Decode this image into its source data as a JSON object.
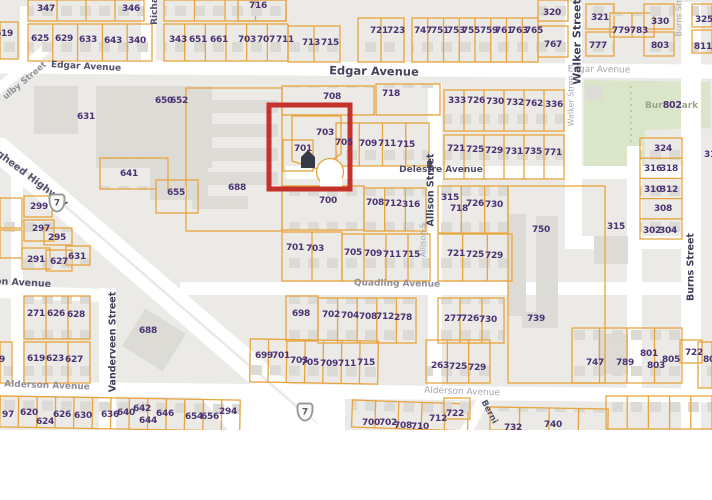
{
  "map": {
    "colors": {
      "block": "#ebeae6",
      "road": "#ffffff",
      "parcel_line": "#e8a43e",
      "building": "#dcdbd6",
      "park": "#dbe5c9",
      "number_text": "#4a3273",
      "highlight": "#c5312b"
    },
    "highlight": {
      "x": 269,
      "y": 105,
      "w": 81,
      "h": 84,
      "stroke": 5
    },
    "highway_shields": [
      {
        "label": "7",
        "x": 57,
        "y": 203
      },
      {
        "label": "7",
        "x": 305,
        "y": 412
      }
    ],
    "park_label": {
      "pre": "Bur",
      "number": "802",
      "post": "ark"
    },
    "street_labels": [
      {
        "t": "Edgar Avenue",
        "x": 86,
        "y": 67,
        "rot": 3,
        "cls": "s-dark",
        "size": 9
      },
      {
        "t": "Edgar Avenue",
        "x": 374,
        "y": 71,
        "rot": 1,
        "cls": "s-bold",
        "size": 11.5
      },
      {
        "t": "Edgar Avenue",
        "x": 599,
        "y": 70,
        "rot": 1,
        "cls": "s-light",
        "size": 9
      },
      {
        "t": "Delestre Avenue",
        "x": 441,
        "y": 170,
        "rot": 0,
        "cls": "s-dark",
        "size": 9
      },
      {
        "t": "Quadling Avenue",
        "x": 397,
        "y": 284,
        "rot": 1,
        "cls": "s-mid",
        "size": 9
      },
      {
        "t": "Alderson Avenue",
        "x": 47,
        "y": 386,
        "rot": 2,
        "cls": "s-mid",
        "size": 9
      },
      {
        "t": "Alderson Avenue",
        "x": 462,
        "y": 392,
        "rot": 2,
        "cls": "s-light",
        "size": 9
      },
      {
        "t": "Walker Street",
        "x": 577,
        "y": 42,
        "rot": -90,
        "cls": "s-bold2",
        "size": 11
      },
      {
        "t": "Walker Stree",
        "x": 571,
        "y": 101,
        "rot": -90,
        "cls": "s-light",
        "size": 8
      },
      {
        "t": "Burns Str",
        "x": 679,
        "y": 18,
        "rot": -90,
        "cls": "s-light",
        "size": 8
      },
      {
        "t": "Burns Street",
        "x": 691,
        "y": 267,
        "rot": -90,
        "cls": "s-bold2",
        "size": 9.5
      },
      {
        "t": "Allison Street",
        "x": 431,
        "y": 190,
        "rot": -90,
        "cls": "s-bold2",
        "size": 9.5
      },
      {
        "t": "Allison S",
        "x": 423,
        "y": 240,
        "rot": -90,
        "cls": "s-light",
        "size": 8
      },
      {
        "t": "Vanderveen Street",
        "x": 113,
        "y": 342,
        "rot": -90,
        "cls": "s-bold2",
        "size": 9.5
      },
      {
        "t": "Richa",
        "x": 155,
        "y": 11,
        "rot": -90,
        "cls": "s-dark",
        "size": 9
      },
      {
        "t": "gheed Highway",
        "x": 32,
        "y": 179,
        "rot": 37,
        "cls": "s-hwy",
        "size": 10
      },
      {
        "t": "ulby Street",
        "x": 25,
        "y": 81,
        "rot": -40,
        "cls": "s-mid",
        "size": 8.5
      },
      {
        "t": "on Avenue",
        "x": 23,
        "y": 283,
        "rot": 3,
        "cls": "s-dark",
        "size": 9.5
      },
      {
        "t": "Berni",
        "x": 489,
        "y": 412,
        "rot": 62,
        "cls": "s-dark",
        "size": 8.5
      }
    ],
    "parcel_numbers": [
      [
        "347",
        46,
        9
      ],
      [
        "346",
        131,
        9
      ],
      [
        "619",
        4,
        34
      ],
      [
        "625",
        40,
        39
      ],
      [
        "629",
        64,
        39
      ],
      [
        "633",
        88,
        40
      ],
      [
        "643",
        113,
        41
      ],
      [
        "340",
        137,
        41
      ],
      [
        "343",
        178,
        40
      ],
      [
        "651",
        198,
        40
      ],
      [
        "661",
        219,
        40
      ],
      [
        "703",
        247,
        40
      ],
      [
        "707",
        266,
        40
      ],
      [
        "711",
        285,
        40
      ],
      [
        "713",
        311,
        43
      ],
      [
        "715",
        330,
        43
      ],
      [
        "716",
        258,
        6
      ],
      [
        "721",
        379,
        31
      ],
      [
        "723",
        396,
        31
      ],
      [
        "747",
        423,
        31
      ],
      [
        "751",
        440,
        31
      ],
      [
        "753",
        456,
        31
      ],
      [
        "755",
        471,
        31
      ],
      [
        "759",
        489,
        31
      ],
      [
        "761",
        504,
        31
      ],
      [
        "763",
        519,
        31
      ],
      [
        "765",
        534,
        31
      ],
      [
        "320",
        552,
        13
      ],
      [
        "767",
        553,
        45
      ],
      [
        "321",
        600,
        18
      ],
      [
        "777",
        598,
        46
      ],
      [
        "779",
        621,
        31
      ],
      [
        "783",
        639,
        31
      ],
      [
        "330",
        660,
        22
      ],
      [
        "803",
        660,
        46
      ],
      [
        "325",
        704,
        20
      ],
      [
        "811",
        703,
        47
      ],
      [
        "650",
        164,
        101
      ],
      [
        "652",
        179,
        101
      ],
      [
        "631",
        86,
        117
      ],
      [
        "708",
        332,
        97
      ],
      [
        "718",
        391,
        94
      ],
      [
        "333",
        457,
        101
      ],
      [
        "726",
        476,
        101
      ],
      [
        "730",
        495,
        102
      ],
      [
        "732",
        515,
        103
      ],
      [
        "762",
        534,
        104
      ],
      [
        "336",
        554,
        105
      ],
      [
        "703",
        325,
        133
      ],
      [
        "701",
        303,
        149
      ],
      [
        "705",
        344,
        143
      ],
      [
        "709",
        368,
        144
      ],
      [
        "711",
        387,
        144
      ],
      [
        "715",
        406,
        145
      ],
      [
        "721",
        456,
        149
      ],
      [
        "725",
        475,
        150
      ],
      [
        "729",
        494,
        151
      ],
      [
        "731",
        514,
        152
      ],
      [
        "735",
        533,
        152
      ],
      [
        "771",
        553,
        153
      ],
      [
        "641",
        129,
        174
      ],
      [
        "655",
        176,
        193
      ],
      [
        "688",
        237,
        188
      ],
      [
        "299",
        39,
        207
      ],
      [
        "297",
        41,
        229
      ],
      [
        "295",
        57,
        238
      ],
      [
        "291",
        36,
        260
      ],
      [
        "627",
        59,
        262
      ],
      [
        "631",
        77,
        257
      ],
      [
        "700",
        328,
        201
      ],
      [
        "708",
        375,
        203
      ],
      [
        "712",
        393,
        204
      ],
      [
        "316",
        411,
        205
      ],
      [
        "315",
        450,
        198
      ],
      [
        "718",
        459,
        209
      ],
      [
        "726",
        475,
        204
      ],
      [
        "730",
        494,
        205
      ],
      [
        "701",
        295,
        248
      ],
      [
        "703",
        315,
        249
      ],
      [
        "705",
        353,
        253
      ],
      [
        "709",
        373,
        254
      ],
      [
        "711",
        392,
        255
      ],
      [
        "715",
        411,
        255
      ],
      [
        "721",
        456,
        254
      ],
      [
        "725",
        475,
        255
      ],
      [
        "729",
        494,
        256
      ],
      [
        "750",
        541,
        230
      ],
      [
        "739",
        536,
        319
      ],
      [
        "324",
        663,
        149
      ],
      [
        "316",
        653,
        169
      ],
      [
        "318",
        669,
        169
      ],
      [
        "310",
        653,
        190
      ],
      [
        "312",
        669,
        190
      ],
      [
        "308",
        663,
        209
      ],
      [
        "302",
        652,
        231
      ],
      [
        "304",
        668,
        231
      ],
      [
        "315",
        616,
        227
      ],
      [
        "31",
        710,
        155
      ],
      [
        "698",
        301,
        314
      ],
      [
        "702",
        331,
        315
      ],
      [
        "704",
        350,
        316
      ],
      [
        "708",
        368,
        317
      ],
      [
        "712",
        385,
        317
      ],
      [
        "278",
        403,
        318
      ],
      [
        "277",
        453,
        319
      ],
      [
        "726",
        470,
        319
      ],
      [
        "730",
        488,
        320
      ],
      [
        "271",
        36,
        314
      ],
      [
        "626",
        56,
        314
      ],
      [
        "628",
        76,
        315
      ],
      [
        "619",
        36,
        359
      ],
      [
        "623",
        55,
        359
      ],
      [
        "627",
        74,
        360
      ],
      [
        "9",
        2,
        360
      ],
      [
        "688",
        148,
        331
      ],
      [
        "699",
        264,
        356
      ],
      [
        "701",
        281,
        356
      ],
      [
        "703",
        299,
        361
      ],
      [
        "705",
        310,
        363
      ],
      [
        "709",
        329,
        364
      ],
      [
        "711",
        347,
        364
      ],
      [
        "715",
        366,
        363
      ],
      [
        "263",
        440,
        366
      ],
      [
        "725",
        458,
        367
      ],
      [
        "729",
        477,
        368
      ],
      [
        "747",
        595,
        363
      ],
      [
        "789",
        625,
        363
      ],
      [
        "801",
        649,
        354
      ],
      [
        "803",
        656,
        366
      ],
      [
        "805",
        671,
        360
      ],
      [
        "80",
        709,
        360
      ],
      [
        "722",
        694,
        353
      ],
      [
        "97",
        8,
        415
      ],
      [
        "620",
        29,
        413
      ],
      [
        "624",
        45,
        422
      ],
      [
        "626",
        62,
        415
      ],
      [
        "630",
        83,
        416
      ],
      [
        "636",
        110,
        415
      ],
      [
        "640",
        126,
        413
      ],
      [
        "642",
        142,
        409
      ],
      [
        "644",
        148,
        421
      ],
      [
        "646",
        165,
        414
      ],
      [
        "654",
        194,
        417
      ],
      [
        "656",
        210,
        417
      ],
      [
        "294",
        228,
        412
      ],
      [
        "700",
        371,
        423
      ],
      [
        "702",
        388,
        423
      ],
      [
        "708",
        403,
        426
      ],
      [
        "710",
        420,
        427
      ],
      [
        "712",
        438,
        419
      ],
      [
        "722",
        455,
        414
      ],
      [
        "732",
        513,
        428
      ],
      [
        "740",
        553,
        425
      ]
    ]
  }
}
